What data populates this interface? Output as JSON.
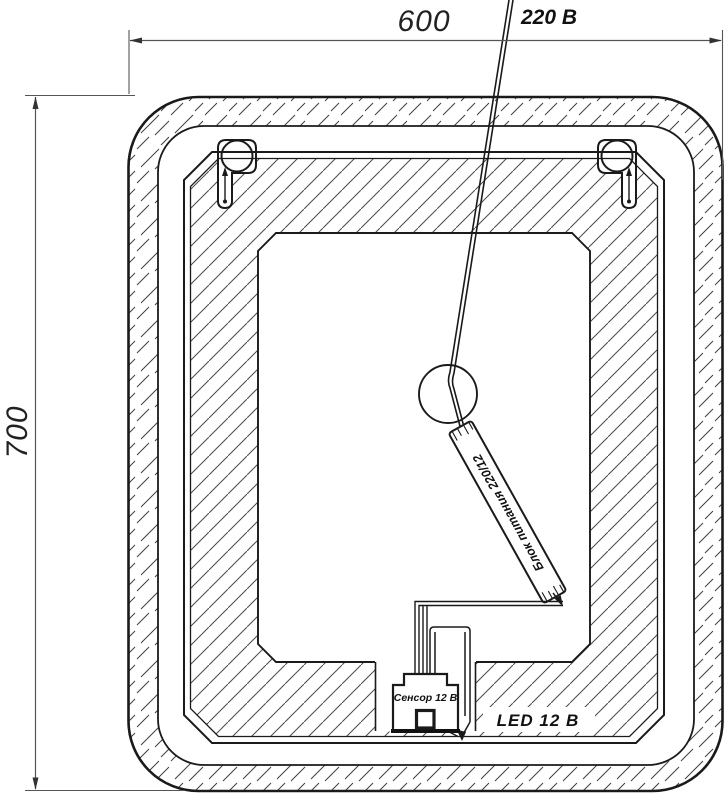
{
  "drawing": {
    "dim_width": "600",
    "dim_height": "700",
    "cable_label": "220 В",
    "psu_label": "Блок питания 220/12",
    "sensor_label": "Сенсор 12 В",
    "led_label": "LED 12 В",
    "colors": {
      "line": "#1a1a1a",
      "dimension": "#555555",
      "hatch": "#3f3f3f",
      "background": "#ffffff"
    }
  }
}
